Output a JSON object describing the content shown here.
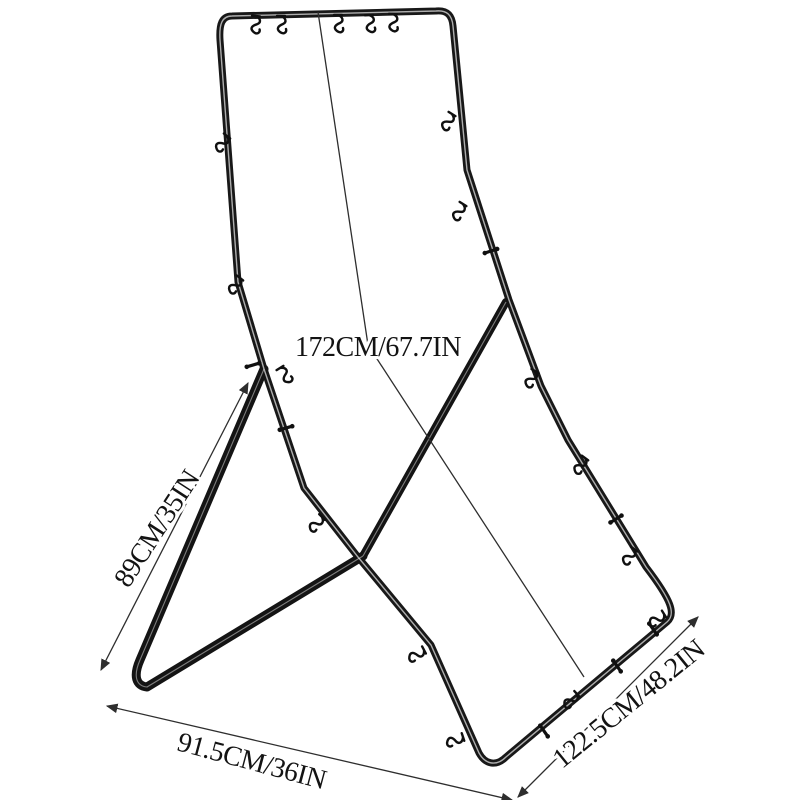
{
  "page": {
    "background_color": "#ffffff"
  },
  "product": {
    "name": "black metal tube hanging-frame stand with S-hooks and clips",
    "frame_color": "#181818",
    "tube_highlight_color": "#ffffff",
    "top_bar_hook_count": 5
  },
  "annotations": {
    "line_color": "#2e2e2e",
    "text_color": "#131313",
    "height": {
      "label": "172CM/67.7IN"
    },
    "support_leg": {
      "label": "89CM/35IN"
    },
    "base_width": {
      "label": "91.5CM/36IN"
    },
    "frame_width": {
      "label": "122.5CM/48.2IN"
    }
  }
}
